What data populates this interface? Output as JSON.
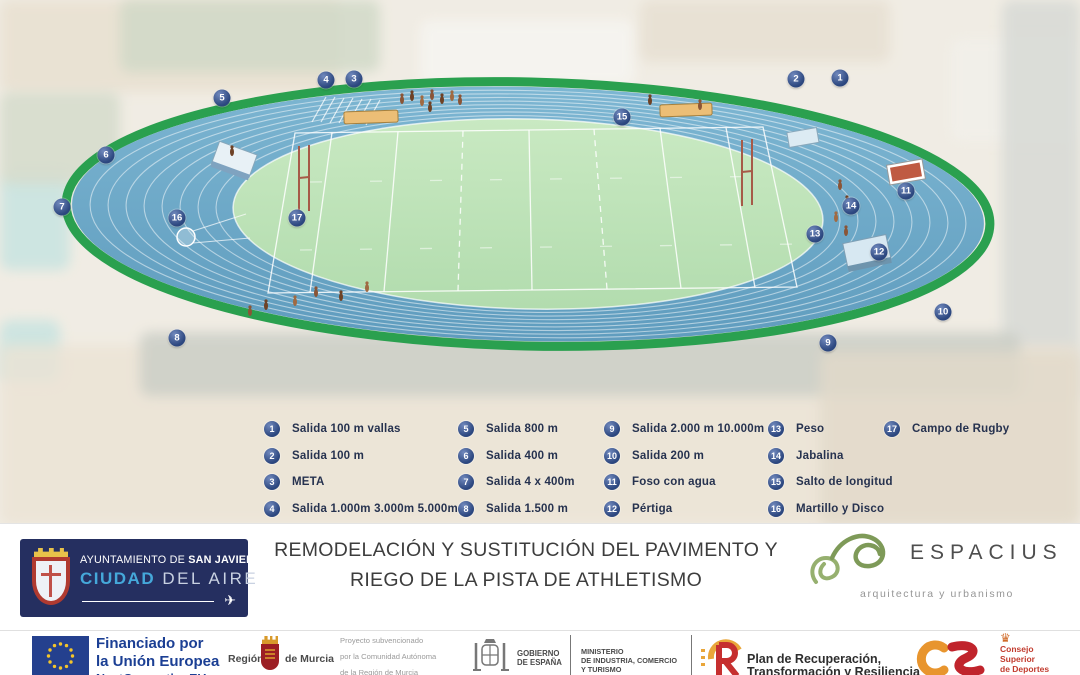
{
  "colors": {
    "marker_navy": "#2c477f",
    "track_green": "#2aa04f",
    "track_blue": "#68a4c5",
    "field_green": "#bfe2ba",
    "eu_blue": "#24408e"
  },
  "track_markers": [
    {
      "num": "1",
      "x": 840,
      "y": 78
    },
    {
      "num": "2",
      "x": 796,
      "y": 79
    },
    {
      "num": "3",
      "x": 354,
      "y": 79
    },
    {
      "num": "4",
      "x": 326,
      "y": 80
    },
    {
      "num": "5",
      "x": 222,
      "y": 98
    },
    {
      "num": "6",
      "x": 106,
      "y": 155
    },
    {
      "num": "7",
      "x": 62,
      "y": 207
    },
    {
      "num": "8",
      "x": 177,
      "y": 338
    },
    {
      "num": "9",
      "x": 828,
      "y": 343
    },
    {
      "num": "10",
      "x": 943,
      "y": 312
    },
    {
      "num": "11",
      "x": 906,
      "y": 191
    },
    {
      "num": "12",
      "x": 879,
      "y": 252
    },
    {
      "num": "13",
      "x": 815,
      "y": 234
    },
    {
      "num": "14",
      "x": 851,
      "y": 206
    },
    {
      "num": "15",
      "x": 622,
      "y": 117
    },
    {
      "num": "16",
      "x": 177,
      "y": 218
    },
    {
      "num": "17",
      "x": 297,
      "y": 218
    }
  ],
  "legend": {
    "columns": [
      {
        "left": 264,
        "items": [
          {
            "num": "1",
            "label": "Salida 100 m vallas"
          },
          {
            "num": "2",
            "label": "Salida 100 m"
          },
          {
            "num": "3",
            "label": "META"
          },
          {
            "num": "4",
            "label": "Salida 1.000m 3.000m 5.000m"
          }
        ]
      },
      {
        "left": 458,
        "items": [
          {
            "num": "5",
            "label": "Salida 800 m"
          },
          {
            "num": "6",
            "label": "Salida 400 m"
          },
          {
            "num": "7",
            "label": "Salida 4 x 400m"
          },
          {
            "num": "8",
            "label": "Salida 1.500 m"
          }
        ]
      },
      {
        "left": 604,
        "items": [
          {
            "num": "9",
            "label": "Salida 2.000 m 10.000m"
          },
          {
            "num": "10",
            "label": "Salida 200 m"
          },
          {
            "num": "11",
            "label": "Foso con agua"
          },
          {
            "num": "12",
            "label": "Pértiga"
          }
        ]
      },
      {
        "left": 768,
        "items": [
          {
            "num": "13",
            "label": "Peso"
          },
          {
            "num": "14",
            "label": "Jabalina"
          },
          {
            "num": "15",
            "label": "Salto de longitud"
          },
          {
            "num": "16",
            "label": "Martillo y Disco"
          }
        ]
      },
      {
        "left": 884,
        "items": [
          {
            "num": "17",
            "label": "Campo de Rugby"
          }
        ]
      }
    ]
  },
  "banner": {
    "title": {
      "line1": "REMODELACIÓN Y SUSTITUCIÓN DEL PAVIMENTO Y",
      "line2": "RIEGO DE LA PISTA DE ATHLETISMO"
    },
    "san_javier": {
      "prefix": "AYUNTAMIENTO DE ",
      "name": "SAN JAVIER",
      "city_blue": "CIUDAD",
      "city_rest": " DEL AIRE"
    },
    "espacius": {
      "name": "ESPACIUS",
      "tagline": "arquitectura y urbanismo"
    }
  },
  "footer": {
    "eu": {
      "line1": "Financiado por",
      "line2": "la Unión Europea",
      "line3": "NextGenerationEU"
    },
    "murcia": {
      "pre": "Región",
      "post": "de Murcia"
    },
    "subsidy_lines": [
      "Proyecto subvencionado",
      "por la Comunidad Autónoma",
      "de la Región de Murcia"
    ],
    "gobierno": {
      "line1": "GOBIERNO",
      "line2": "DE ESPAÑA"
    },
    "ministerio_lines": [
      "MINISTERIO",
      "DE INDUSTRIA, COMERCIO",
      "Y TURISMO"
    ],
    "plan_lines": [
      "Plan de Recuperación,",
      "Transformación y Resiliencia"
    ],
    "csd_lines": [
      "Consejo",
      "Superior",
      "de Deportes"
    ]
  },
  "icons": {
    "plane": "✈",
    "crown": "♛"
  }
}
